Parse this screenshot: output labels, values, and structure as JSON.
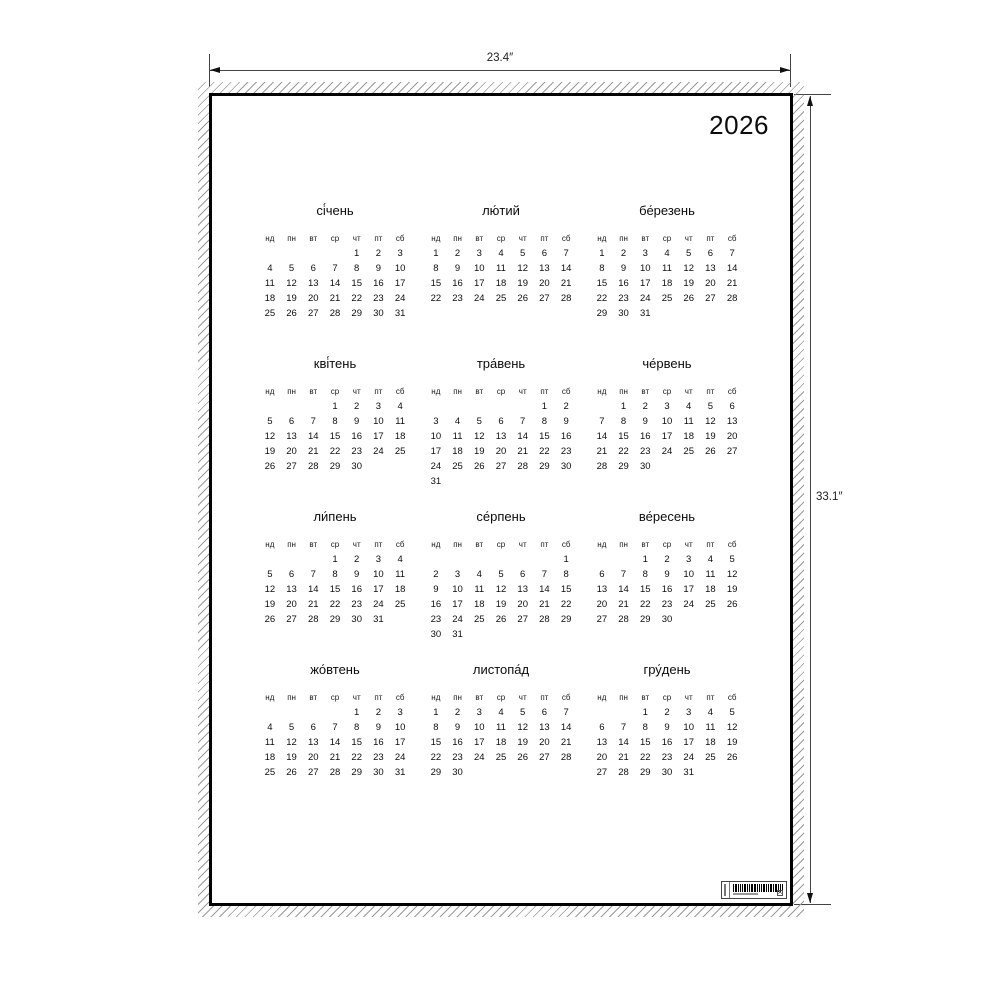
{
  "dimension_annotations": {
    "width_label": "23.4″",
    "height_label": "33.1″"
  },
  "poster": {
    "year": "2026",
    "weekday_headers": [
      "нд",
      "пн",
      "вт",
      "ср",
      "чт",
      "пт",
      "сб"
    ],
    "months": [
      {
        "name": "сі́чень",
        "weeks": [
          [
            "",
            "",
            "",
            "",
            "1",
            "2",
            "3"
          ],
          [
            "4",
            "5",
            "6",
            "7",
            "8",
            "9",
            "10"
          ],
          [
            "11",
            "12",
            "13",
            "14",
            "15",
            "16",
            "17"
          ],
          [
            "18",
            "19",
            "20",
            "21",
            "22",
            "23",
            "24"
          ],
          [
            "25",
            "26",
            "27",
            "28",
            "29",
            "30",
            "31"
          ]
        ]
      },
      {
        "name": "лю́тий",
        "weeks": [
          [
            "1",
            "2",
            "3",
            "4",
            "5",
            "6",
            "7"
          ],
          [
            "8",
            "9",
            "10",
            "11",
            "12",
            "13",
            "14"
          ],
          [
            "15",
            "16",
            "17",
            "18",
            "19",
            "20",
            "21"
          ],
          [
            "22",
            "23",
            "24",
            "25",
            "26",
            "27",
            "28"
          ]
        ]
      },
      {
        "name": "бе́резень",
        "weeks": [
          [
            "1",
            "2",
            "3",
            "4",
            "5",
            "6",
            "7"
          ],
          [
            "8",
            "9",
            "10",
            "11",
            "12",
            "13",
            "14"
          ],
          [
            "15",
            "16",
            "17",
            "18",
            "19",
            "20",
            "21"
          ],
          [
            "22",
            "23",
            "24",
            "25",
            "26",
            "27",
            "28"
          ],
          [
            "29",
            "30",
            "31",
            "",
            "",
            "",
            ""
          ]
        ]
      },
      {
        "name": "кві́тень",
        "weeks": [
          [
            "",
            "",
            "",
            "1",
            "2",
            "3",
            "4"
          ],
          [
            "5",
            "6",
            "7",
            "8",
            "9",
            "10",
            "11"
          ],
          [
            "12",
            "13",
            "14",
            "15",
            "16",
            "17",
            "18"
          ],
          [
            "19",
            "20",
            "21",
            "22",
            "23",
            "24",
            "25"
          ],
          [
            "26",
            "27",
            "28",
            "29",
            "30",
            "",
            ""
          ]
        ]
      },
      {
        "name": "тра́вень",
        "weeks": [
          [
            "",
            "",
            "",
            "",
            "",
            "1",
            "2"
          ],
          [
            "3",
            "4",
            "5",
            "6",
            "7",
            "8",
            "9"
          ],
          [
            "10",
            "11",
            "12",
            "13",
            "14",
            "15",
            "16"
          ],
          [
            "17",
            "18",
            "19",
            "20",
            "21",
            "22",
            "23"
          ],
          [
            "24",
            "25",
            "26",
            "27",
            "28",
            "29",
            "30"
          ],
          [
            "31",
            "",
            "",
            "",
            "",
            "",
            ""
          ]
        ]
      },
      {
        "name": "че́рвень",
        "weeks": [
          [
            "",
            "1",
            "2",
            "3",
            "4",
            "5",
            "6"
          ],
          [
            "7",
            "8",
            "9",
            "10",
            "11",
            "12",
            "13"
          ],
          [
            "14",
            "15",
            "16",
            "17",
            "18",
            "19",
            "20"
          ],
          [
            "21",
            "22",
            "23",
            "24",
            "25",
            "26",
            "27"
          ],
          [
            "28",
            "29",
            "30",
            "",
            "",
            "",
            ""
          ]
        ]
      },
      {
        "name": "ли́пень",
        "weeks": [
          [
            "",
            "",
            "",
            "1",
            "2",
            "3",
            "4"
          ],
          [
            "5",
            "6",
            "7",
            "8",
            "9",
            "10",
            "11"
          ],
          [
            "12",
            "13",
            "14",
            "15",
            "16",
            "17",
            "18"
          ],
          [
            "19",
            "20",
            "21",
            "22",
            "23",
            "24",
            "25"
          ],
          [
            "26",
            "27",
            "28",
            "29",
            "30",
            "31",
            ""
          ]
        ]
      },
      {
        "name": "се́рпень",
        "weeks": [
          [
            "",
            "",
            "",
            "",
            "",
            "",
            "1"
          ],
          [
            "2",
            "3",
            "4",
            "5",
            "6",
            "7",
            "8"
          ],
          [
            "9",
            "10",
            "11",
            "12",
            "13",
            "14",
            "15"
          ],
          [
            "16",
            "17",
            "18",
            "19",
            "20",
            "21",
            "22"
          ],
          [
            "23",
            "24",
            "25",
            "26",
            "27",
            "28",
            "29"
          ],
          [
            "30",
            "31",
            "",
            "",
            "",
            "",
            ""
          ]
        ]
      },
      {
        "name": "ве́ресень",
        "weeks": [
          [
            "",
            "",
            "1",
            "2",
            "3",
            "4",
            "5"
          ],
          [
            "6",
            "7",
            "8",
            "9",
            "10",
            "11",
            "12"
          ],
          [
            "13",
            "14",
            "15",
            "16",
            "17",
            "18",
            "19"
          ],
          [
            "20",
            "21",
            "22",
            "23",
            "24",
            "25",
            "26"
          ],
          [
            "27",
            "28",
            "29",
            "30",
            "",
            "",
            ""
          ]
        ]
      },
      {
        "name": "жо́втень",
        "weeks": [
          [
            "",
            "",
            "",
            "",
            "1",
            "2",
            "3"
          ],
          [
            "4",
            "5",
            "6",
            "7",
            "8",
            "9",
            "10"
          ],
          [
            "11",
            "12",
            "13",
            "14",
            "15",
            "16",
            "17"
          ],
          [
            "18",
            "19",
            "20",
            "21",
            "22",
            "23",
            "24"
          ],
          [
            "25",
            "26",
            "27",
            "28",
            "29",
            "30",
            "31"
          ]
        ]
      },
      {
        "name": "листопа́д",
        "weeks": [
          [
            "1",
            "2",
            "3",
            "4",
            "5",
            "6",
            "7"
          ],
          [
            "8",
            "9",
            "10",
            "11",
            "12",
            "13",
            "14"
          ],
          [
            "15",
            "16",
            "17",
            "18",
            "19",
            "20",
            "21"
          ],
          [
            "22",
            "23",
            "24",
            "25",
            "26",
            "27",
            "28"
          ],
          [
            "29",
            "30",
            "",
            "",
            "",
            "",
            ""
          ]
        ]
      },
      {
        "name": "гру́день",
        "weeks": [
          [
            "",
            "",
            "1",
            "2",
            "3",
            "4",
            "5"
          ],
          [
            "6",
            "7",
            "8",
            "9",
            "10",
            "11",
            "12"
          ],
          [
            "13",
            "14",
            "15",
            "16",
            "17",
            "18",
            "19"
          ],
          [
            "20",
            "21",
            "22",
            "23",
            "24",
            "25",
            "26"
          ],
          [
            "27",
            "28",
            "29",
            "30",
            "31",
            "",
            ""
          ]
        ]
      }
    ],
    "barcode_label": {
      "bar_pattern": "1211121122111211212111",
      "boxed_letter": "A",
      "microtext_legible": false
    }
  },
  "colors": {
    "background": "#ffffff",
    "frame": "#000000",
    "text": "#111111",
    "hatch": "#9a9a9a",
    "dimension_lines": "#444444"
  }
}
